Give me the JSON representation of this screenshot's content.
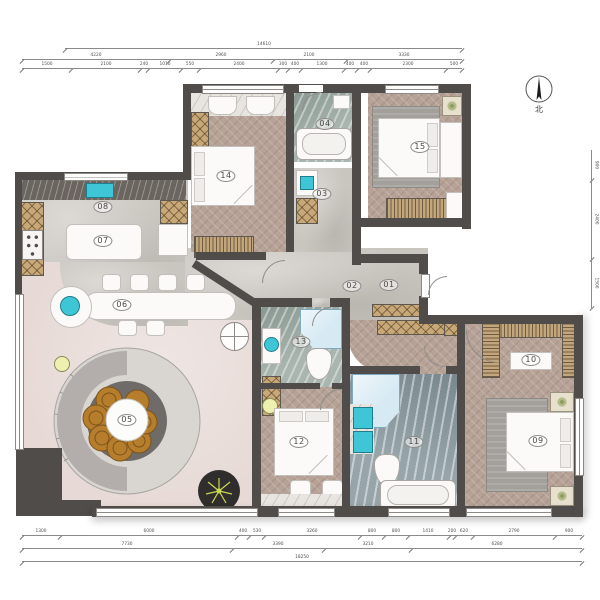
{
  "palette": {
    "wall": "#4f4c49",
    "wood_floor": "#b6a296",
    "concrete_floor": "#c9c5bf",
    "pink_floor": "#e7dad6",
    "teal_fixture": "#3ec6d6",
    "marble_green": "#a9b5af",
    "marble_blue": "#97a5aa",
    "wardrobe_tan": "#c9a878",
    "seat_orange": "#b57d2c"
  },
  "plan": {
    "north_label": "北",
    "room_labels": [
      {
        "text": "01",
        "x": 389,
        "y": 285
      },
      {
        "text": "02",
        "x": 352,
        "y": 286
      },
      {
        "text": "03",
        "x": 322,
        "y": 194
      },
      {
        "text": "04",
        "x": 325,
        "y": 124
      },
      {
        "text": "05",
        "x": 127,
        "y": 420
      },
      {
        "text": "06",
        "x": 122,
        "y": 305
      },
      {
        "text": "07",
        "x": 103,
        "y": 241
      },
      {
        "text": "08",
        "x": 103,
        "y": 207
      },
      {
        "text": "09",
        "x": 538,
        "y": 441
      },
      {
        "text": "10",
        "x": 531,
        "y": 360
      },
      {
        "text": "11",
        "x": 414,
        "y": 442
      },
      {
        "text": "12",
        "x": 299,
        "y": 442
      },
      {
        "text": "13",
        "x": 301,
        "y": 342
      },
      {
        "text": "14",
        "x": 226,
        "y": 176
      },
      {
        "text": "15",
        "x": 420,
        "y": 147
      }
    ],
    "dimensions": {
      "top": [
        {
          "x0": 65,
          "x1": 462,
          "y": 41,
          "segments": [
            "14610"
          ]
        },
        {
          "x0": 22,
          "x1": 462,
          "y": 52,
          "segments": [
            "4220",
            "2960",
            "2100",
            "3330"
          ]
        },
        {
          "x0": 22,
          "x1": 462,
          "y": 61,
          "segments": [
            "1500",
            "2100",
            "240",
            "1010",
            "550",
            "2400",
            "300",
            "400",
            "1300",
            "400",
            "400",
            "2300",
            "500"
          ]
        }
      ],
      "bottom": [
        {
          "x0": 22,
          "x1": 582,
          "y": 528,
          "segments": [
            "1300",
            "6000",
            "400",
            "530",
            "3260",
            "800",
            "800",
            "1410",
            "200",
            "620",
            "2790",
            "900"
          ]
        },
        {
          "x0": 22,
          "x1": 582,
          "y": 541,
          "segments": [
            "7730",
            "3390",
            "3210",
            "6280"
          ]
        },
        {
          "x0": 22,
          "x1": 582,
          "y": 554,
          "segments": [
            "18250"
          ]
        }
      ],
      "right": [
        {
          "x": 591,
          "y0": 150,
          "y1": 308,
          "segments": [
            "900",
            "2400",
            "1500"
          ]
        }
      ]
    }
  }
}
